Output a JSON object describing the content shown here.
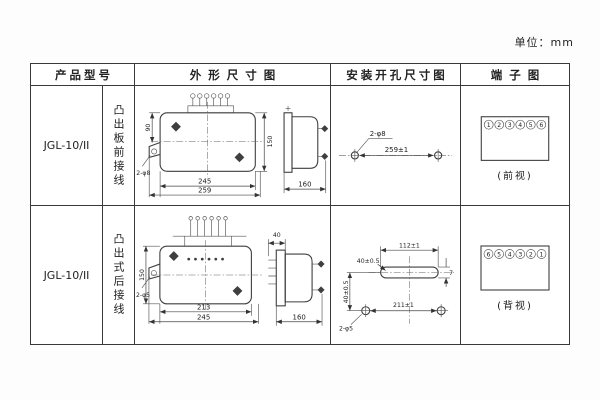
{
  "page": {
    "unit_label": "单位：mm"
  },
  "table": {
    "headers": {
      "model": "产品型号",
      "outline": "外形尺寸图",
      "install": "安装开孔尺寸图",
      "terminal": "端子图"
    }
  },
  "rows": [
    {
      "model": "JGL-10/II",
      "wiring": "凸出板前接线",
      "outline": {
        "width_inner": "245",
        "width_outer": "259",
        "height": "150",
        "left_height": "90",
        "ear_hole_label": "2-φ8",
        "side_depth": "160"
      },
      "install": {
        "hole_label": "2-φ8",
        "span": "259±1"
      },
      "terminal": {
        "numbers": [
          "1",
          "2",
          "3",
          "4",
          "5",
          "6"
        ],
        "view": "(前视)"
      }
    },
    {
      "model": "JGL-10/II",
      "wiring": "凸出式后接线",
      "outline": {
        "width_inner": "213",
        "width_outer": "245",
        "height": "150",
        "side_top": "40",
        "ear_hole_label": "2-φ5",
        "side_depth": "160"
      },
      "install": {
        "slot_span": "112±1",
        "v_offset_left": "40±0.5",
        "v_offset_leader": "40±0.5",
        "slot_height": "7",
        "hole_label": "2-φ5",
        "span": "211±1"
      },
      "terminal": {
        "numbers": [
          "6",
          "5",
          "4",
          "3",
          "2",
          "1"
        ],
        "view": "(背视)"
      }
    }
  ]
}
